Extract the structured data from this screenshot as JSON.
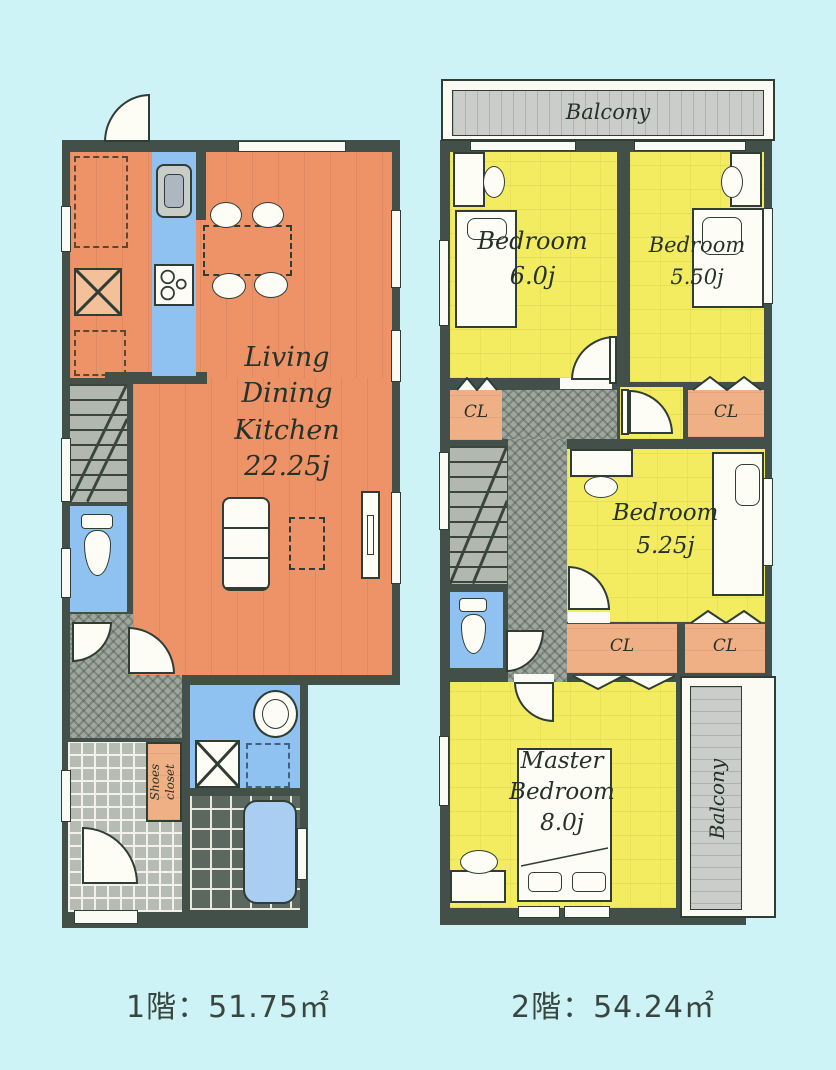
{
  "colors": {
    "background": "#cdf3f6",
    "wall": "#43504a",
    "ldk_orange": "#ee9268",
    "bedroom_yellow": "#f3ec60",
    "water_blue": "#8fc2f0",
    "closet_peach": "#f0b086",
    "balcony_gray": "#cacdc9",
    "hall_gray": "#9ea69d",
    "label_ink": "#25322a"
  },
  "floor1": {
    "caption": "1階：51.75㎡",
    "rooms": {
      "ldk": {
        "name_lines": [
          "Living",
          "Dining",
          "Kitchen"
        ],
        "size": "22.25j"
      },
      "shoes_closet": {
        "name_lines": [
          "Shoes",
          "closet"
        ]
      }
    }
  },
  "floor2": {
    "caption": "2階：54.24㎡",
    "balconies": {
      "top": "Balcony",
      "side": "Balcony"
    },
    "rooms": {
      "bedroom1": {
        "name": "Bedroom",
        "size": "6.0j"
      },
      "bedroom2": {
        "name": "Bedroom",
        "size": "5.50j"
      },
      "bedroom3": {
        "name": "Bedroom",
        "size": "5.25j"
      },
      "master_bedroom": {
        "name_lines": [
          "Master",
          "Bedroom"
        ],
        "size": "8.0j"
      },
      "closets": {
        "cl1": "CL",
        "cl2": "CL",
        "cl3": "CL",
        "cl4": "CL"
      }
    }
  }
}
